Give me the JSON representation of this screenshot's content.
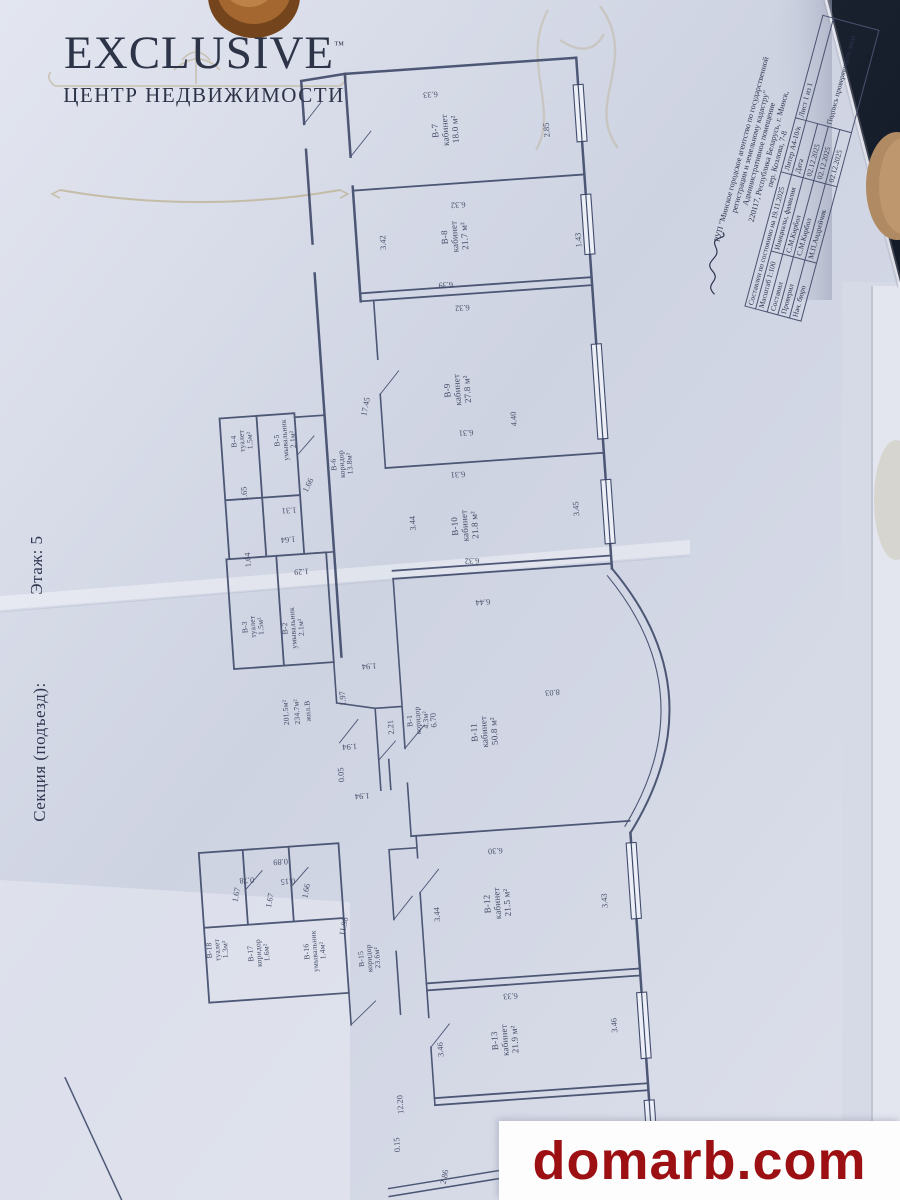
{
  "branding": {
    "logo_title": "EXCLUSIVE",
    "logo_tm": "™",
    "logo_subtitle": "ЦЕНТР НЕДВИЖИМОСТИ"
  },
  "margin": {
    "section_label": "Секция (подъезд):",
    "floor_label": "Этаж: 5"
  },
  "watermark": {
    "text": "domarb.com",
    "color": "#9c1013"
  },
  "title_block": {
    "org_line1": "РУП \"Минское городское агентство по государственной",
    "org_line2": "регистрации и земельному кадастру\"",
    "premise": "Административное помещение",
    "address_line1": "220117, Республика Беларусь, г. Минск,",
    "address_line2": "пер. Козлова, 7-8",
    "composed": "Составлен по состоянию на 19.11.2025",
    "liter": "Литер А4-10/к",
    "sheet": "Лист 1 из 1",
    "scale_label": "Масштаб",
    "scale_value": "1:100",
    "names_header": "Инициалы, фамилия",
    "date_header": "Дата",
    "sign_header": "Подпись проверяющего лица",
    "rows": [
      {
        "role": "Составил",
        "name": "С.М.Кирбол",
        "date": "02.12.2025"
      },
      {
        "role": "Проверил",
        "name": "С.М.Кирбол",
        "date": "02.12.2025"
      },
      {
        "role": "Нач. бюро",
        "name": "М.П.Андрейчик",
        "date": "02.12.2025"
      }
    ]
  },
  "plan": {
    "rooms": [
      {
        "id": "В-1",
        "type": "коридор",
        "area": "4.3м²"
      },
      {
        "id": "В-2",
        "type": "умывальник",
        "area": "2.1м²"
      },
      {
        "id": "В-3",
        "type": "туалет",
        "area": "1.5м²"
      },
      {
        "id": "В-4",
        "type": "туалет",
        "area": "1.5м²"
      },
      {
        "id": "В-5",
        "type": "умывальник",
        "area": "2.1м²"
      },
      {
        "id": "В-6",
        "type": "коридор",
        "area": "13.8м²"
      },
      {
        "id": "В-7",
        "type": "кабинет",
        "area": "18.0 м²"
      },
      {
        "id": "В-8",
        "type": "кабинет",
        "area": "21.7 м²"
      },
      {
        "id": "В-9",
        "type": "кабинет",
        "area": "27.8 м²"
      },
      {
        "id": "В-10",
        "type": "кабинет",
        "area": "21.8 м²"
      },
      {
        "id": "В-11",
        "type": "кабинет",
        "area": "50.8 м²"
      },
      {
        "id": "В-12",
        "type": "кабинет",
        "area": "21.5 м²"
      },
      {
        "id": "В-13",
        "type": "кабинет",
        "area": "21.9 м²"
      },
      {
        "id": "В-15",
        "type": "коридор",
        "area": "23.6м²"
      },
      {
        "id": "В-16",
        "type": "умывальник",
        "area": "1.4м²"
      },
      {
        "id": "В-17",
        "type": "коридор",
        "area": "1.6м²"
      },
      {
        "id": "В-18",
        "type": "туалет",
        "area": "1.3м²"
      }
    ],
    "summary": {
      "area1": "201.5м²",
      "area2": "234.7м²",
      "label": "жил.В"
    },
    "dims": [
      "6.33",
      "2.85",
      "6.32",
      "3.42",
      "1.43",
      "6.39",
      "6.32",
      "17.45",
      "4.40",
      "6.31",
      "6.31",
      "3.44",
      "3.45",
      "6.32",
      "6.44",
      "6.70",
      "2.21",
      "8.03",
      "6.30",
      "3.44",
      "3.43",
      "6.33",
      "3.46",
      "3.46",
      "12.20",
      "0.15",
      "2.86",
      "1.65",
      "1.31",
      "1.64",
      "1.64",
      "1.29",
      "1.66",
      "1.94",
      "1.97",
      "1.94",
      "0.05",
      "1.94",
      "0.78",
      "0.89",
      "0.15",
      "1.67",
      "1.67",
      "1.66",
      "11.98"
    ]
  },
  "colors": {
    "paper": "#d3d8e6",
    "ink": "#3a4566",
    "gold": "#b6a57a",
    "logo_navy": "#2d3448",
    "watermark_red": "#9c1013"
  }
}
